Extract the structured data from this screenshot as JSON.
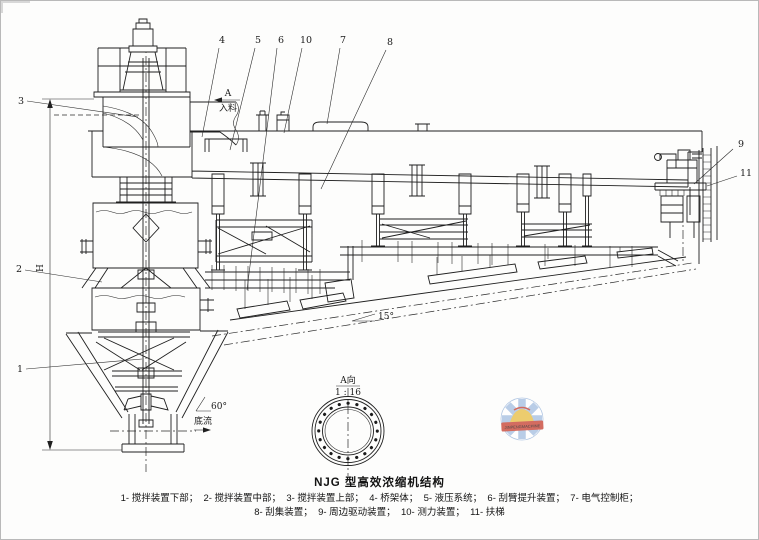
{
  "figure": {
    "title": "NJG 型高效浓缩机结构",
    "caption_line1": "1- 搅拌装置下部；  2- 搅拌装置中部；  3- 搅拌装置上部；  4- 桥架体；  5- 液压系统；  6- 刮臂提升装置；  7- 电气控制柜；",
    "caption_line2": "8- 刮集装置；  9- 周边驱动装置；  10- 测力装置；  11- 扶梯"
  },
  "callouts": {
    "c1": "1",
    "c2": "2",
    "c3": "3",
    "c4": "4",
    "c5": "5",
    "c6": "6",
    "c7": "7",
    "c8": "8",
    "c9": "9",
    "c10": "10",
    "c11": "11"
  },
  "annotations": {
    "section_letter": "A",
    "feed": "入料",
    "cone_angle": "60°",
    "underflow": "底流",
    "floor_angle": "15°",
    "view_label": "A向",
    "view_scale": "1 : 16",
    "height_dim": "H"
  },
  "watermark": {
    "band_text": "JINPENGMACHINE",
    "ray_color": "#a9c2e2",
    "band_color": "#c9483a",
    "center_color": "#e9c04b"
  }
}
